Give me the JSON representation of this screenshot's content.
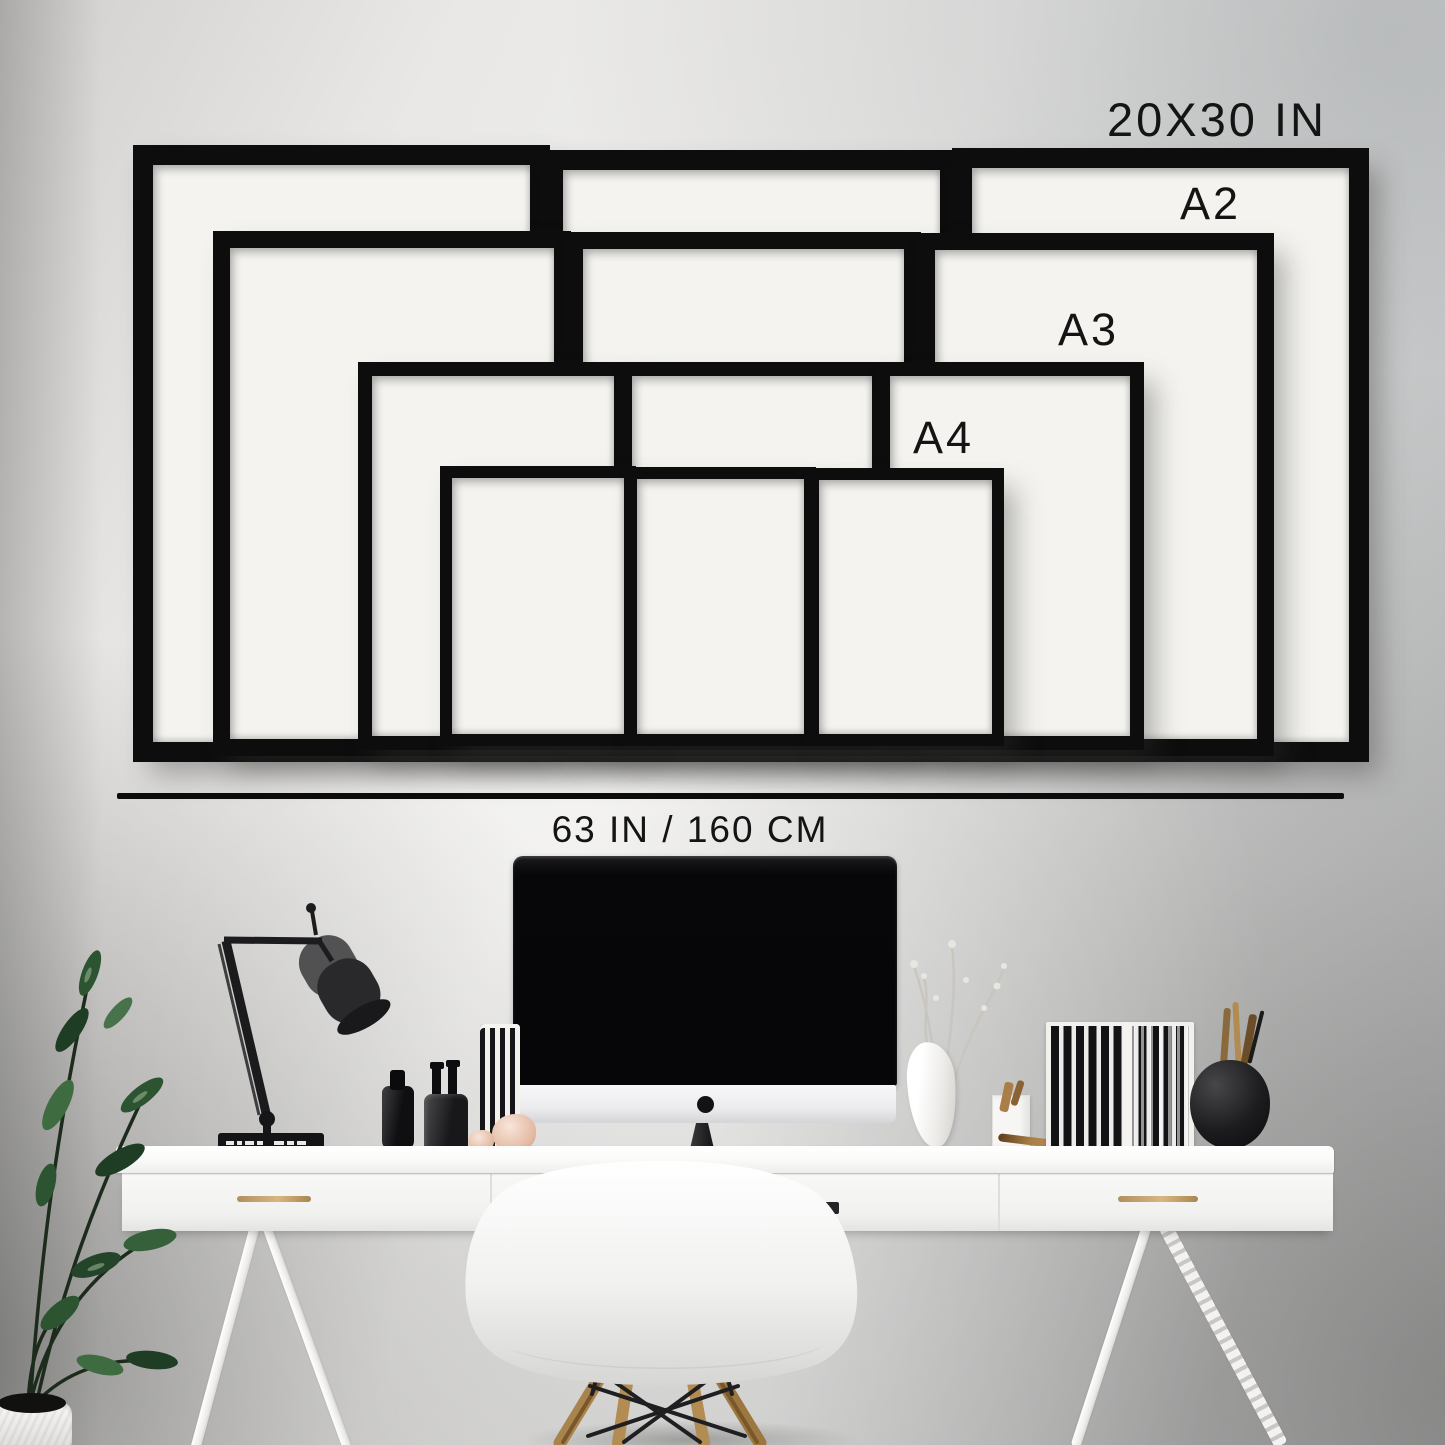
{
  "scene": {
    "description": "Gallery wall frame size guide mockup above a white home-office desk"
  },
  "size_labels": {
    "largest": "20X30 IN",
    "a2": "A2",
    "a3": "A3",
    "a4": "A4"
  },
  "measurement": {
    "wall_width": "63 IN / 160 CM"
  },
  "frames": {
    "sizes": [
      "20X30 IN",
      "A2",
      "A3",
      "A4"
    ],
    "count_per_size": 3,
    "total": 12,
    "frame_color": "#0d0d0e",
    "mat_color": "#f4f3ef"
  },
  "colors": {
    "text": "#141414",
    "divider_line": "#0c0c0c",
    "wall_light": "#efeeec",
    "wall_shadow": "#c3c6c8",
    "desk": "#fafaf9",
    "handle_brass": "#c8a36f",
    "chair_wood": "#a9834c",
    "plant_green": "#2c5431"
  }
}
